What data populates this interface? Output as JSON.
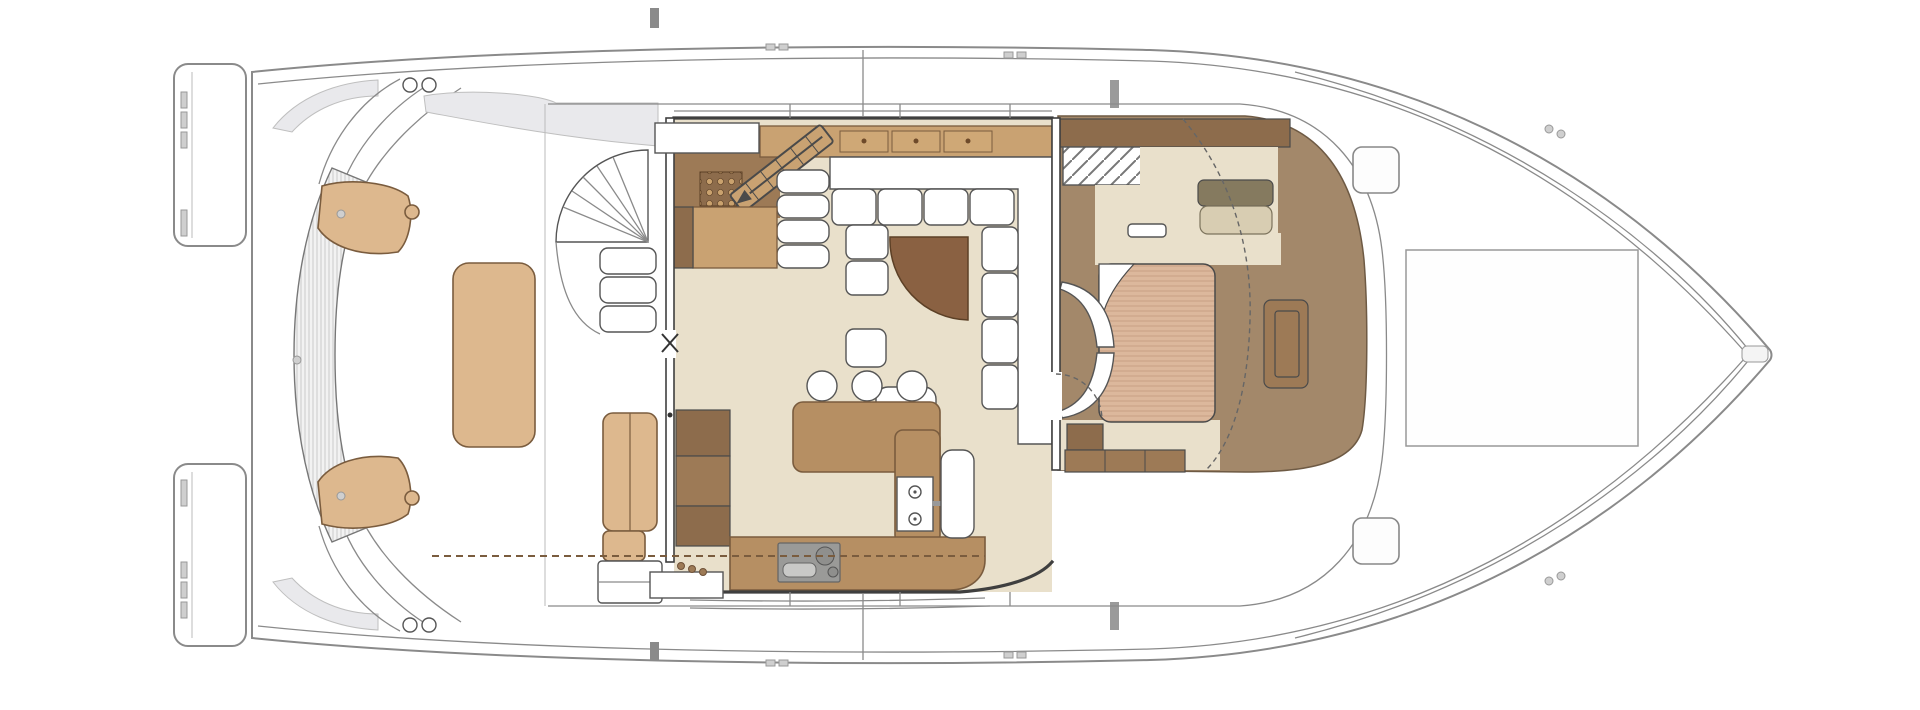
{
  "meta": {
    "title": "Catamaran motor yacht — main deck floor plan",
    "orientation": "bow-right",
    "visible_text": "none"
  },
  "palette": {
    "hull": "#ffffff",
    "outline": "#8a8a8a",
    "wall": "#3f3f3f",
    "shade": "#e9e9ec",
    "cockpitWood": "#ddb88e",
    "floor": "#e9e0cb",
    "counterWood": "#b68f63",
    "cabinetDark": "#8d6c4c",
    "cabinetMid": "#9d7a56",
    "drawerWood": "#c9a272",
    "tableWood": "#8a6142",
    "cabinBrown": "#a3886a",
    "khaki": "#857a5f",
    "khakiLight": "#d8cdb2",
    "mattress": "#dcb89c",
    "mattressLine": "#c9a183",
    "appliance": "#9a9a98",
    "benchFill": "#f2f2f2",
    "benchStripe": "#c9c9c9"
  },
  "areas": {
    "stern": {
      "name": "Transom and swim platforms",
      "features": [
        "port-swim-platform",
        "starboard-swim-platform",
        "transom-arches",
        "davit-fittings",
        "transom-steps"
      ]
    },
    "cockpit": {
      "name": "Aft cockpit",
      "features": [
        "curved-transom-bench",
        "bench-end-cushions",
        "cockpit-table",
        "flybridge-spiral-stairs",
        "side-bench",
        "boarding-step"
      ]
    },
    "salon": {
      "name": "Salon and galley",
      "features": [
        "sliding-glass-door",
        "u-shaped-sofa",
        "quarter-round-table",
        "sideboard-drawers",
        "companionway-stairs-down",
        "tile-inlay",
        "tall-cabinets",
        "galley-island",
        "bar-stools",
        "cooktop-module",
        "aft-galley-counter",
        "sink-module",
        "armchair"
      ]
    },
    "master_cabin": {
      "name": "Forward master cabin",
      "features": [
        "island-berth",
        "curved-headboard",
        "turned-sheet-corner",
        "wardrobe",
        "mirrored-locker",
        "dressing-seat",
        "side-shelf",
        "nightstand",
        "storage-cabinets",
        "foot-bench",
        "entry-door-swing",
        "coachroof-dashed-line"
      ]
    },
    "foredeck": {
      "name": "Foredeck",
      "features": [
        "deck-hatch-port",
        "deck-hatch-starboard",
        "sun-pad-outline",
        "anchor-fitting",
        "bow-cleats"
      ]
    }
  },
  "counts": {
    "bar_stools": 3,
    "deck_hatches": 2,
    "sideboard_drawers": 3,
    "cooktop_knobs": 2,
    "spiral_stair_treads": 3
  }
}
